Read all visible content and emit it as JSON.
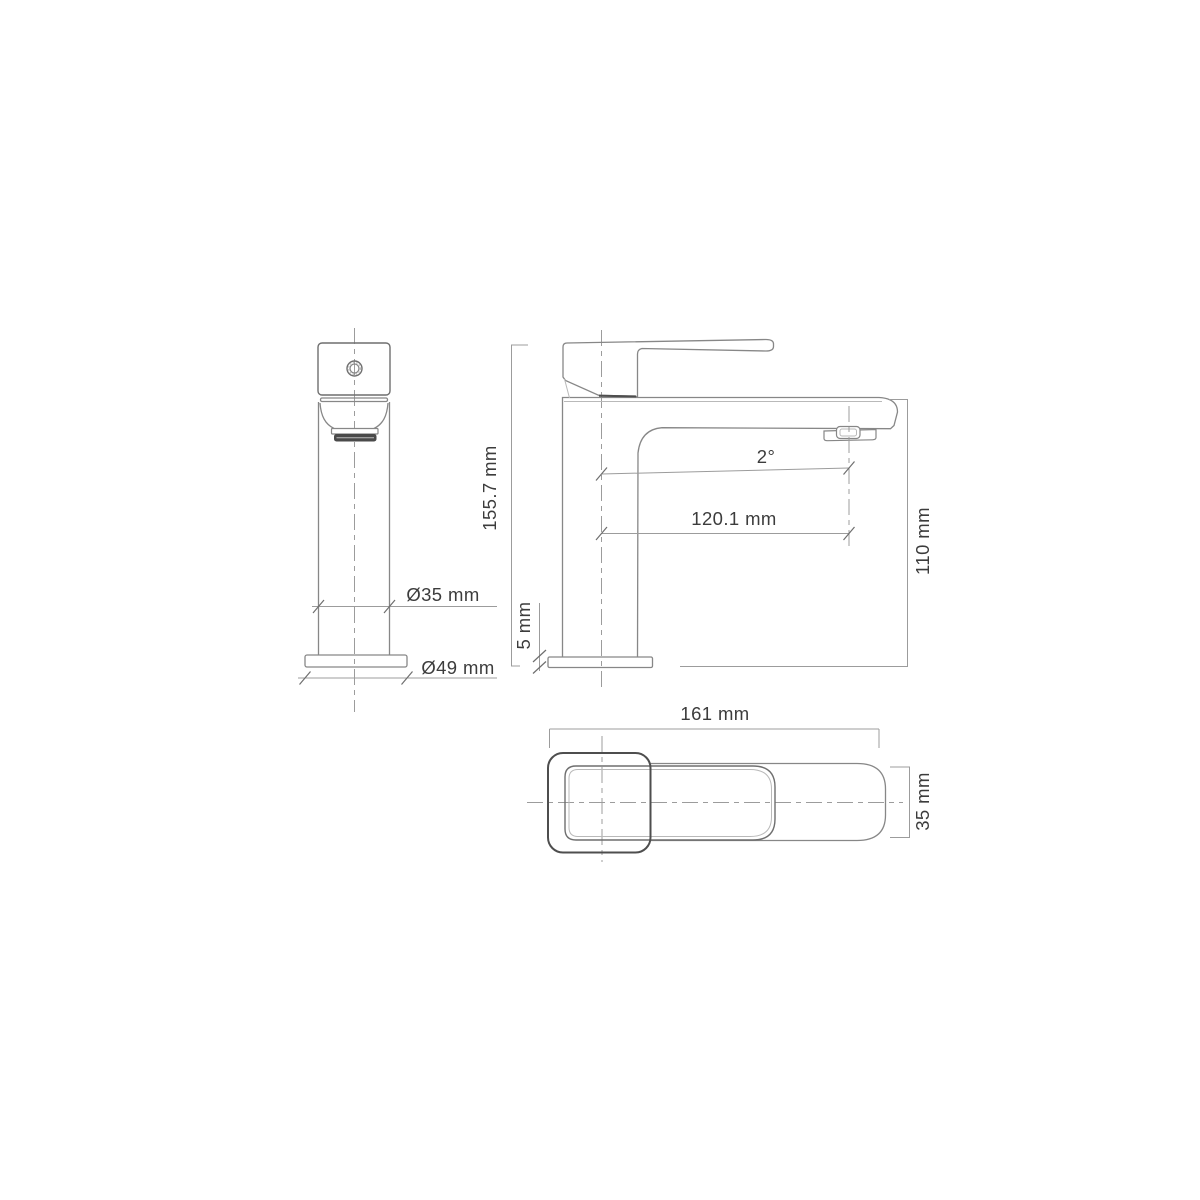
{
  "drawing": {
    "type": "technical-dimension-drawing",
    "subject": "single-lever basin mixer tap, three orthographic views",
    "views": {
      "front": {
        "name": "front view"
      },
      "side": {
        "name": "side view"
      },
      "top": {
        "name": "top view"
      }
    }
  },
  "labels": {
    "front_body_diameter": "Ø35 mm",
    "front_base_diameter": "Ø49 mm",
    "side_total_height": "155.7 mm",
    "side_base_height": "5 mm",
    "side_spout_angle": "2°",
    "side_spout_reach": "120.1 mm",
    "side_spout_height": "110 mm",
    "top_total_length": "161 mm",
    "top_handle_width": "35 mm"
  },
  "colors": {
    "line": "#878787",
    "line_light": "#b9b9b9",
    "line_med": "#6f6f6f",
    "line_dark": "#4e4e4e",
    "dim": "#9c9c9c",
    "tick": "#6e6e6e",
    "text": "#3c3c3c",
    "fill_dark": "#4a4a4a",
    "background": "#ffffff"
  }
}
